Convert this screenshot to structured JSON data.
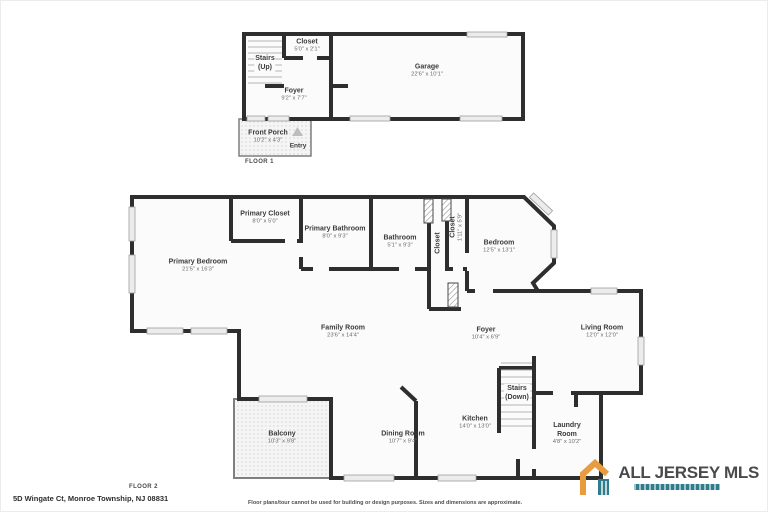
{
  "floor1": {
    "label": "FLOOR 1",
    "rooms": {
      "closet": {
        "name": "Closet",
        "dims": "5'0\" x 2'1\""
      },
      "stairs": {
        "name": "Stairs",
        "dims": "(Up)"
      },
      "garage": {
        "name": "Garage",
        "dims": "22'6\" x 10'1\""
      },
      "foyer": {
        "name": "Foyer",
        "dims": "9'2\" x 7'7\""
      },
      "front_porch": {
        "name": "Front Porch",
        "dims": "10'2\" x 4'3\""
      },
      "entry": {
        "name": "Entry"
      }
    }
  },
  "floor2": {
    "label": "FLOOR 2",
    "rooms": {
      "primary_closet": {
        "name": "Primary Closet",
        "dims": "8'0\" x 5'0\""
      },
      "primary_bathroom": {
        "name": "Primary Bathroom",
        "dims": "8'0\" x 9'3\""
      },
      "bathroom": {
        "name": "Bathroom",
        "dims": "5'1\" x 9'3\""
      },
      "closet_small": {
        "name": "Closet"
      },
      "closet_hall": {
        "name": "Closet",
        "dims": "1'11\" x 5'9\""
      },
      "bedroom": {
        "name": "Bedroom",
        "dims": "12'5\" x 13'1\""
      },
      "primary_bedroom": {
        "name": "Primary Bedroom",
        "dims": "21'5\" x 16'3\""
      },
      "family_room": {
        "name": "Family Room",
        "dims": "23'6\" x 14'4\""
      },
      "foyer": {
        "name": "Foyer",
        "dims": "10'4\" x 6'9\""
      },
      "living_room": {
        "name": "Living Room",
        "dims": "12'0\" x 12'0\""
      },
      "stairs": {
        "name": "Stairs",
        "dims": "(Down)"
      },
      "kitchen": {
        "name": "Kitchen",
        "dims": "14'0\" x 13'0\""
      },
      "laundry_room": {
        "name": "Laundry Room",
        "dims": "4'8\" x 10'2\""
      },
      "balcony": {
        "name": "Balcony",
        "dims": "10'3\" x 9'8\""
      },
      "dining_room": {
        "name": "Dining Room",
        "dims": "10'7\" x 9'4\""
      }
    }
  },
  "footer": {
    "address": "5D Wingate Ct, Monroe Township, NJ 08831",
    "disclaimer": "Floor plans/tour cannot be used for building or design purposes. Sizes and dimensions are approximate."
  },
  "brand": {
    "name": "ALL JERSEY MLS",
    "colors": {
      "orange": "#E89C3F",
      "teal": "#2F7D8C",
      "text": "#4A4A4A"
    }
  }
}
